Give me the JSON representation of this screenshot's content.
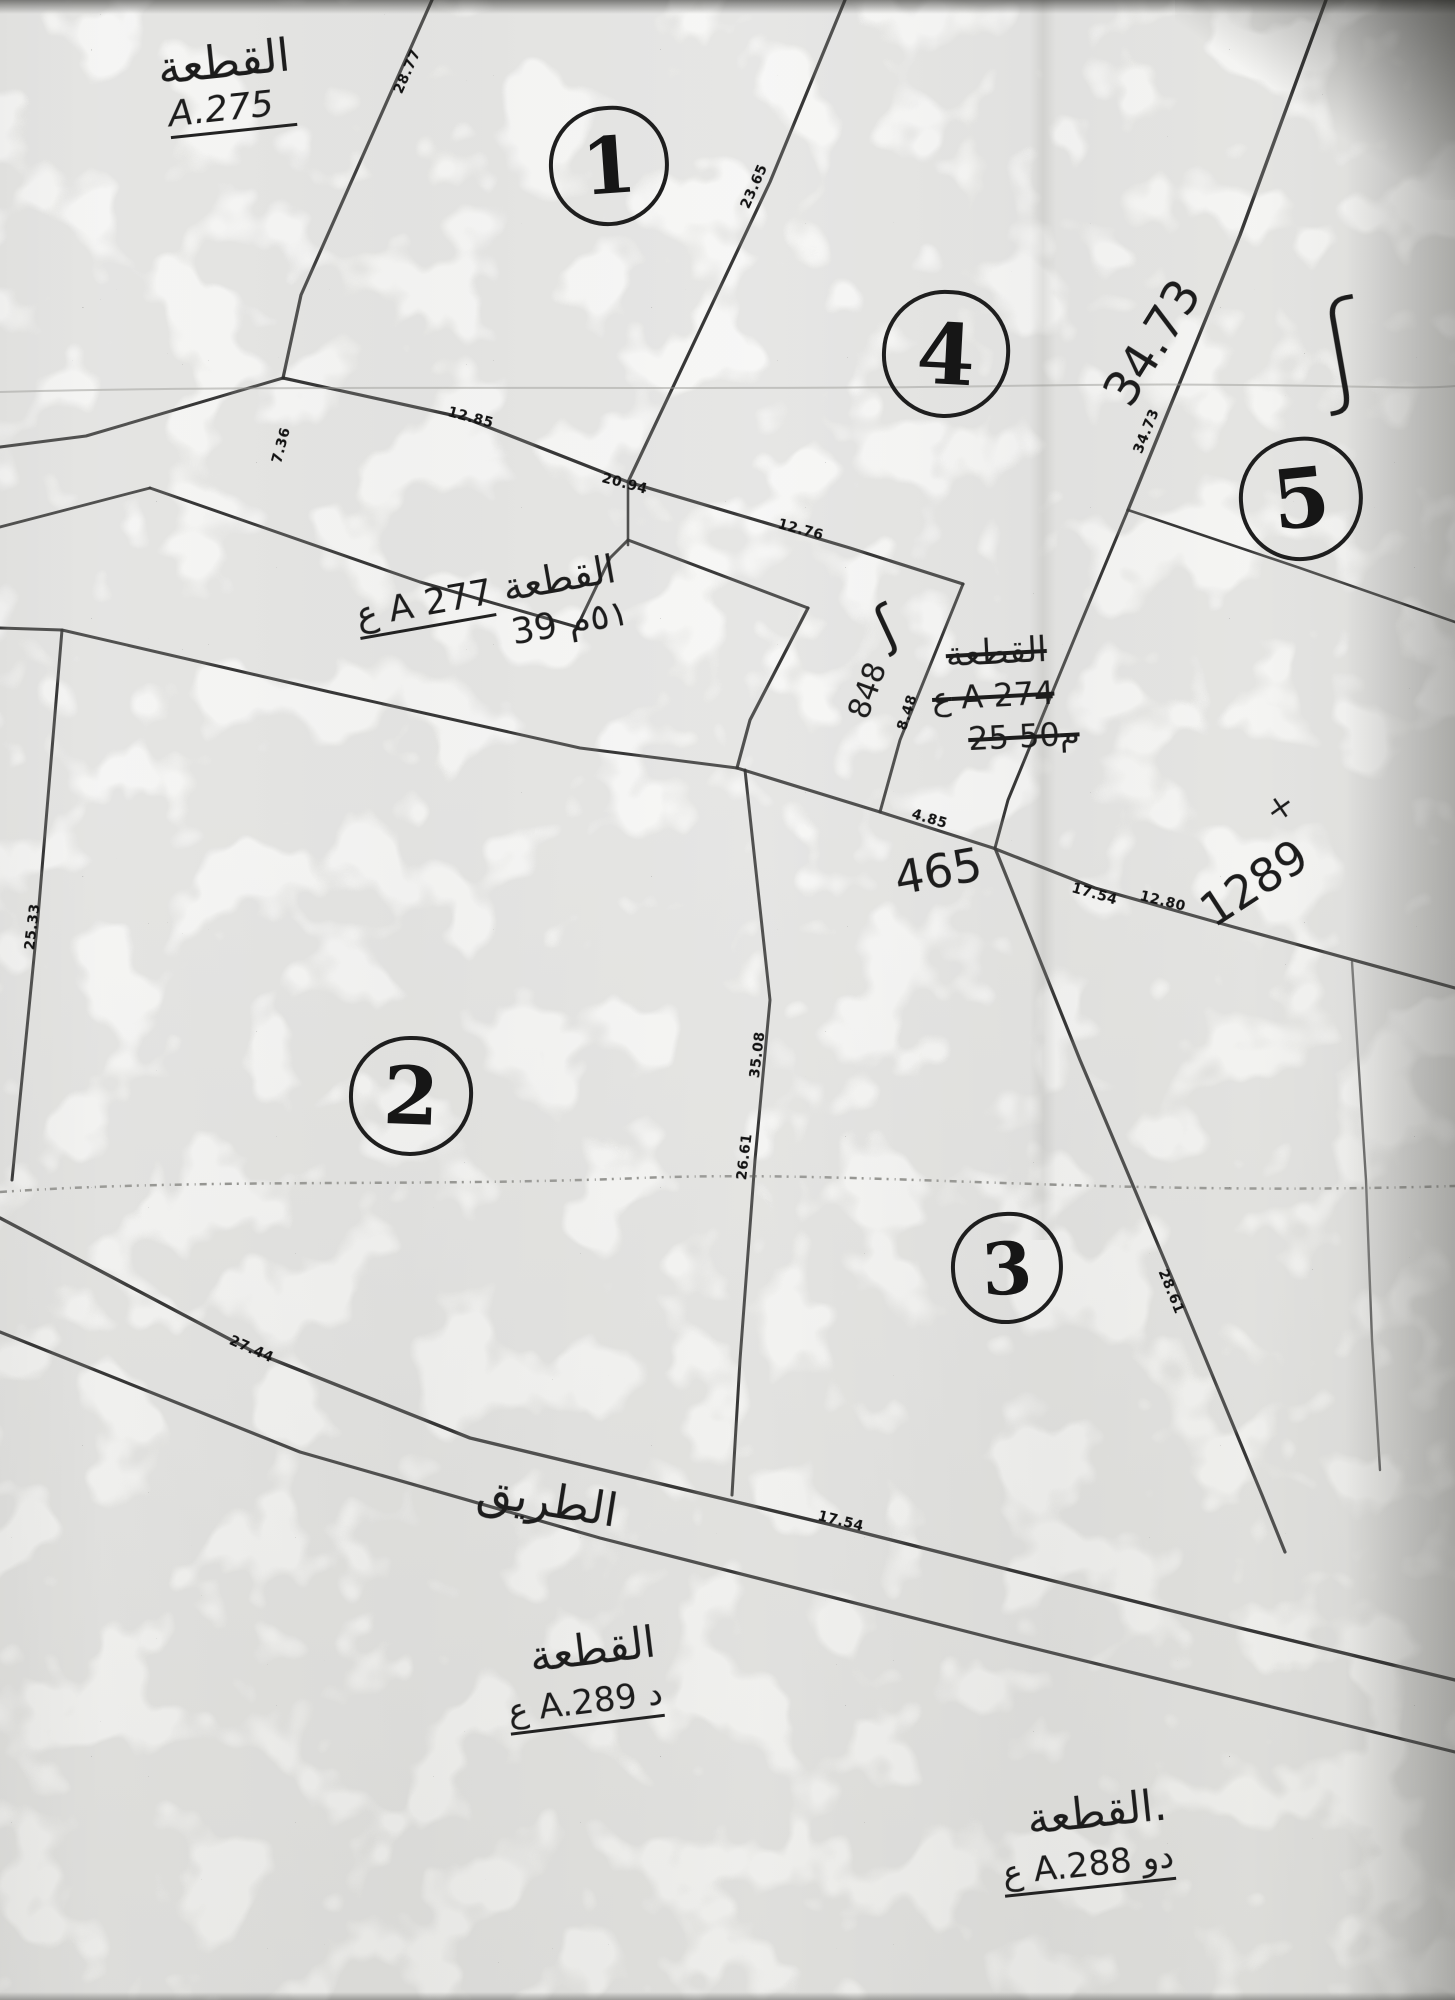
{
  "badges": {
    "b1": "1",
    "b2": "2",
    "b3": "3",
    "b4": "4",
    "b5": "5"
  },
  "parcels": {
    "a275": {
      "arabic": "القطعة",
      "code": "A.275"
    },
    "a277": {
      "arabic": "القطعة",
      "code": "ع A 277",
      "area": "٥١م 39"
    },
    "a274_struck": {
      "arabic": "القطعة",
      "code": "ع A 274",
      "area": "25 50م"
    },
    "a289": {
      "arabic": "القطعة",
      "code": "ع A.289 د"
    },
    "a288": {
      "arabic": "القطعة.",
      "code": "ع A.288 دو"
    }
  },
  "road": {
    "name": "الطريق"
  },
  "measurements": {
    "m28_77": "28.77",
    "m23_65": "23.65",
    "m34_73_hw": "34.73",
    "m34_73": "34.73",
    "m12_85": "12.85",
    "m20_94": "20.94",
    "m12_76": "12.76",
    "m7_36": "7.36",
    "m8_48": "8.48",
    "m848": "848",
    "m4_85": "4.85",
    "m465": "465",
    "m17_54": "17.54",
    "m12_80": "12.80",
    "m1289": "1289",
    "m35_08": "35.08",
    "m26_61": "26.61",
    "m28_61": "28.61",
    "m27_44": "27.44",
    "m17_54_road": "17.54",
    "m25_33": "25.33"
  },
  "marks": {
    "squiggle": "ʃ",
    "curl": "ʃ",
    "cross": "×"
  }
}
